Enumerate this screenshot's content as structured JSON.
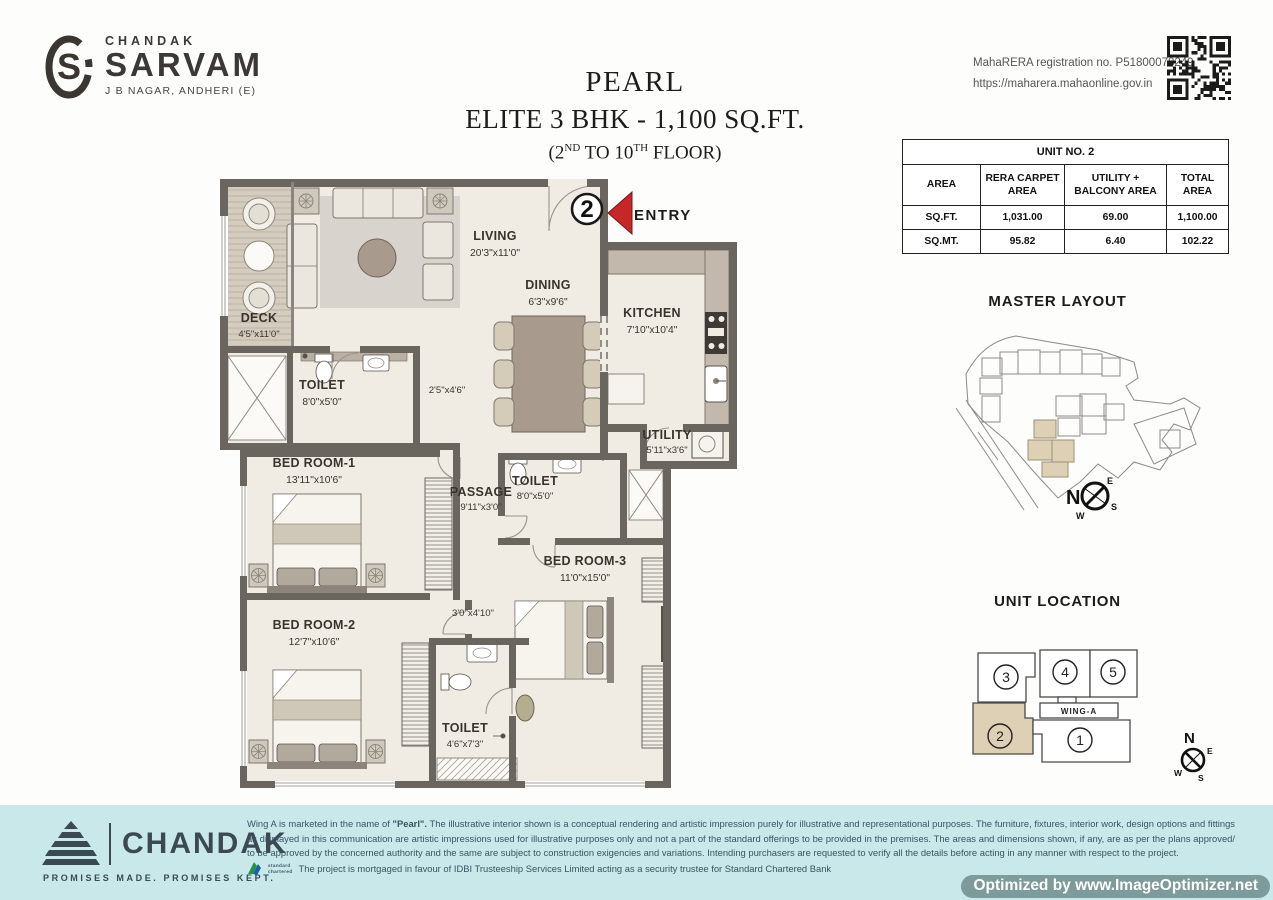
{
  "header": {
    "brand": {
      "name": "CHANDAK",
      "project": "SARVAM",
      "location": "J B NAGAR, ANDHERI (E)",
      "monogram": "S"
    },
    "title": {
      "line1": "PEARL",
      "line2": "ELITE 3 BHK - 1,100 SQ.FT.",
      "line3_a": "(2",
      "line3_sup1": "ND",
      "line3_b": " TO 10",
      "line3_sup2": "TH",
      "line3_c": " FLOOR)"
    },
    "rera": {
      "line1": "MahaRERA registration no. P51800078249",
      "line2": "https://maharera.mahaonline.gov.in"
    }
  },
  "unit_table": {
    "title": "UNIT NO. 2",
    "columns": [
      "AREA",
      "RERA CARPET AREA",
      "UTILITY + BALCONY AREA",
      "TOTAL AREA"
    ],
    "rows": [
      {
        "label": "SQ.FT.",
        "values": [
          "1,031.00",
          "69.00",
          "1,100.00"
        ]
      },
      {
        "label": "SQ.MT.",
        "values": [
          "95.82",
          "6.40",
          "102.22"
        ]
      }
    ]
  },
  "floor_plan": {
    "entry": {
      "label": "ENTRY",
      "unit_number": "2"
    },
    "rooms": {
      "living": {
        "name": "LIVING",
        "dims": "20'3\"x11'0\""
      },
      "dining": {
        "name": "DINING",
        "dims": "6'3\"x9'6\""
      },
      "kitchen": {
        "name": "KITCHEN",
        "dims": "7'10\"x10'4\""
      },
      "deck": {
        "name": "DECK",
        "dims": "4'5\"x11'0\""
      },
      "toilet1": {
        "name": "TOILET",
        "dims": "8'0\"x5'0\""
      },
      "toilet2": {
        "name": "TOILET",
        "dims": "8'0\"x5'0\""
      },
      "toilet3": {
        "name": "TOILET",
        "dims": "4'6\"x7'3\""
      },
      "utility": {
        "name": "UTILITY",
        "dims": "5'11\"x3'6\""
      },
      "passage": {
        "name": "PASSAGE",
        "dims": "9'11\"x3'0\""
      },
      "bed1": {
        "name": "BED ROOM-1",
        "dims": "13'11\"x10'6\""
      },
      "bed2": {
        "name": "BED ROOM-2",
        "dims": "12'7\"x10'6\""
      },
      "bed3": {
        "name": "BED ROOM-3",
        "dims": "11'0\"x15'0\""
      },
      "foyer": {
        "dims": "2'5\"x4'6\""
      },
      "vestibule": {
        "dims": "3'0\"x4'10\""
      }
    }
  },
  "master_layout": {
    "title": "MASTER LAYOUT"
  },
  "unit_location": {
    "title": "UNIT LOCATION",
    "wing_label": "WING-A",
    "highlighted_unit": "2",
    "units": [
      {
        "no": "3"
      },
      {
        "no": "4"
      },
      {
        "no": "5"
      },
      {
        "no": "2"
      },
      {
        "no": "1"
      }
    ]
  },
  "compass": {
    "n": "N",
    "e": "E",
    "s": "S",
    "w": "W"
  },
  "footer": {
    "brand": "CHANDAK",
    "tagline": "PROMISES MADE. PROMISES KEPT.",
    "disclaimer_pre": "Wing A is marketed in the name of ",
    "disclaimer_bold": "\"Pearl\".",
    "disclaimer_rest": " The illustrative interior shown is a conceptual rendering and artistic impression purely for illustrative and representational purposes. The furniture, fixtures, interior work, design options and fittings as displayed in this communication are artistic impressions used for illustrative purposes only and not a part of the standard offerings to be provided in the premises. The areas and dimensions shown, if any, are as per the plans approved/ to be approved by the concerned authority and the same are subject to construction exigencies and variations. Intending purchasers are requested to verify all the details before acting in any manner with respect to the project.",
    "mortgage_note": "The project is mortgaged in favour of IDBI Trusteeship Services Limited acting as a security trustee for Standard Chartered Bank",
    "sc_mark": {
      "line1": "standard",
      "line2": "chartered"
    }
  },
  "watermark": "Optimized by www.ImageOptimizer.net",
  "colors": {
    "accent_red": "#c62828",
    "wall": "#6b6560",
    "floor": "#f0ece4",
    "highlight_tan": "#ddd0b4",
    "footer_bg": "#c8e8ea",
    "watermark_bg": "#769493"
  }
}
